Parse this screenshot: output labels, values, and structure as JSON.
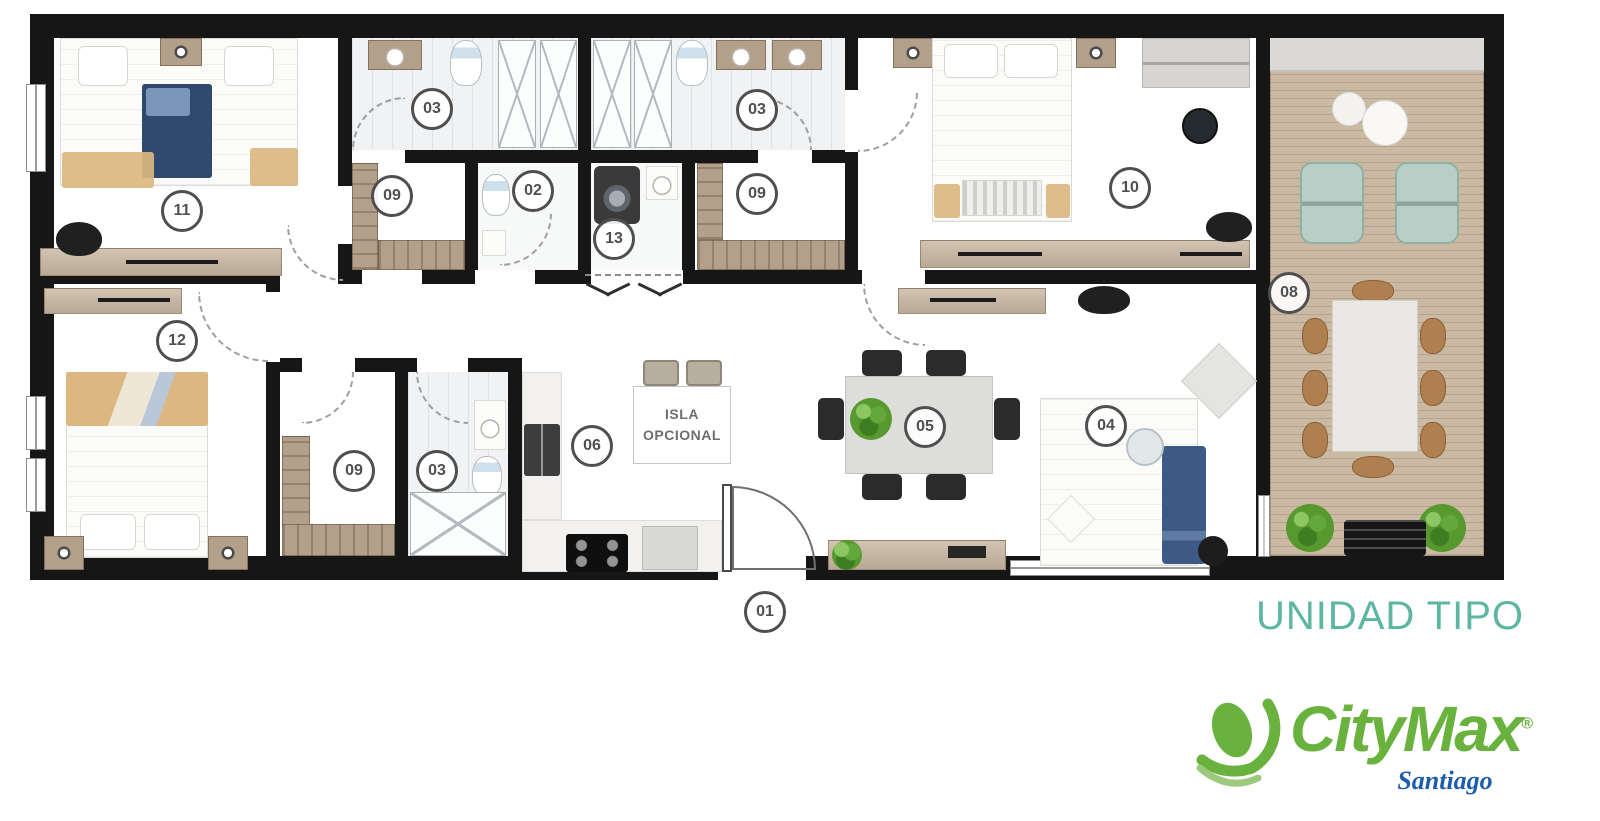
{
  "plan_title": "UNIDAD TIPO",
  "room_labels": [
    {
      "text": "11"
    },
    {
      "text": "03"
    },
    {
      "text": "09"
    },
    {
      "text": "02"
    },
    {
      "text": "13"
    },
    {
      "text": "03"
    },
    {
      "text": "09"
    },
    {
      "text": "10"
    },
    {
      "text": "08"
    },
    {
      "text": "12"
    },
    {
      "text": "09"
    },
    {
      "text": "03"
    },
    {
      "text": "06"
    },
    {
      "text": "05"
    },
    {
      "text": "04"
    },
    {
      "text": "01"
    }
  ],
  "island_label": {
    "line1": "ISLA",
    "line2": "OPCIONAL"
  },
  "logo": {
    "brand": "CityMax",
    "registered": "®",
    "location": "Santiago"
  },
  "colors": {
    "walls": "#161616",
    "title_teal": "#5cb6a2",
    "logo_green": "#6ab23e",
    "logo_blue": "#1d5dad",
    "wood": "#c8b7a1",
    "deck": "#cbbaa3",
    "mint_chair": "#b7cfc6",
    "navy_bedding": "#31486f",
    "sand_bedding": "#dcb77f"
  }
}
